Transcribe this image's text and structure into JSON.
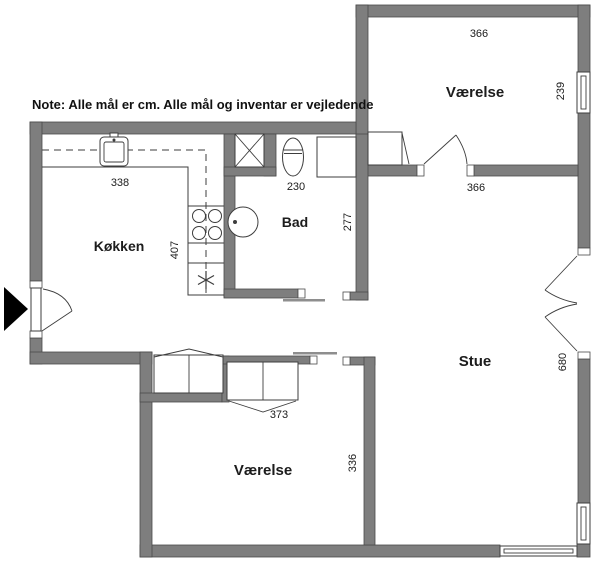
{
  "note": "Note: Alle mål er cm. Alle mål og inventar er vejledende",
  "rooms": {
    "bedroom_top": {
      "label": "Værelse",
      "dim_width": "366",
      "dim_height": "239"
    },
    "living": {
      "label": "Stue",
      "dim_width": "366",
      "dim_height": "680"
    },
    "kitchen": {
      "label": "Køkken",
      "dim_width": "338",
      "dim_height": "407"
    },
    "bath": {
      "label": "Bad",
      "dim_width": "230",
      "dim_height": "277"
    },
    "bedroom_bottom": {
      "label": "Værelse",
      "dim_width": "373",
      "dim_height": "336"
    }
  },
  "colors": {
    "wall": "#7e7e7e",
    "wall_outline": "#4a4a4a",
    "fixture_line": "#3d3d3d",
    "text": "#1c1c1c",
    "background": "#ffffff",
    "entrance_arrow": "#000000"
  }
}
